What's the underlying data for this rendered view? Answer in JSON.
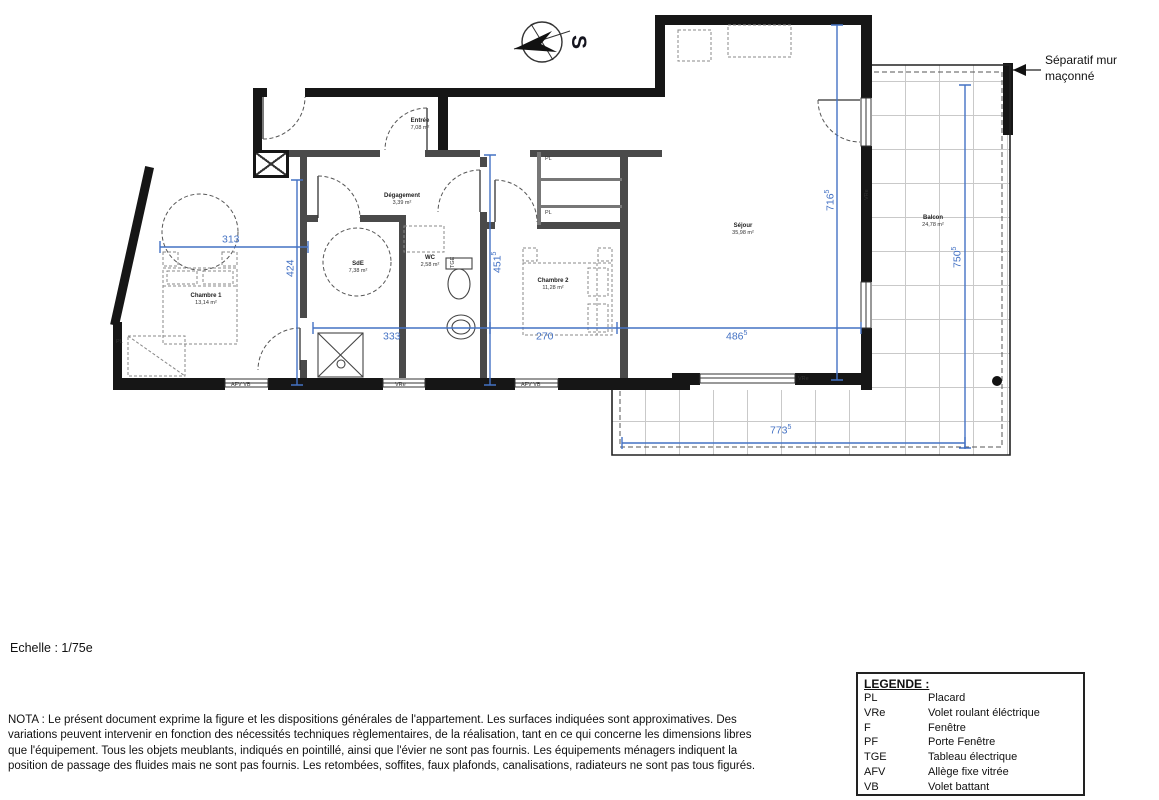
{
  "page": {
    "scale": "Echelle : 1/75e",
    "north_letter": "S",
    "separator_label": "Séparatif mur maçonné",
    "nota": "NOTA : Le présent document exprime la figure et les dispositions générales de l'appartement. Les surfaces indiquées sont approximatives. Des variations peuvent intervenir en fonction des nécessités techniques règlementaires, de la réalisation, tant en ce qui concerne les dimensions libres que l'équipement. Tous les objets meublants, indiqués en pointillé, ainsi que l'évier ne sont pas fournis. Les équipements ménagers indiquent la position de passage des fluides mais ne sont pas fournis. Les retombées, soffites, faux plafonds, canalisations, radiateurs ne sont pas tous figurés."
  },
  "rooms": {
    "entree": {
      "name": "Entrée",
      "area": "7,08 m²"
    },
    "degagement": {
      "name": "Dégagement",
      "area": "3,39 m²"
    },
    "chambre1": {
      "name": "Chambre 1",
      "area": "13,14 m²"
    },
    "sde": {
      "name": "SdE",
      "area": "7,38 m²"
    },
    "wc": {
      "name": "WC",
      "area": "2,58 m²"
    },
    "chambre2": {
      "name": "Chambre 2",
      "area": "11,28 m²"
    },
    "sejour": {
      "name": "Séjour",
      "area": "35,98 m²"
    },
    "balcon": {
      "name": "Balcon",
      "area": "24,78 m²"
    }
  },
  "dimensions": {
    "d313": {
      "text": "313"
    },
    "d424": {
      "text": "424"
    },
    "d333": {
      "text": "333"
    },
    "d270": {
      "text": "270"
    },
    "d451": {
      "text": "451",
      "sup": "5"
    },
    "d486": {
      "text": "486",
      "sup": "5"
    },
    "d716": {
      "text": "716",
      "sup": "5"
    },
    "d750": {
      "text": "750",
      "sup": "5"
    },
    "d773": {
      "text": "773",
      "sup": "5"
    }
  },
  "plan_labels": {
    "pl": "PL",
    "afv_vb": "AFV   VB",
    "vre": "VRe",
    "tge": "TGE"
  },
  "legend": {
    "title": "LEGENDE :",
    "items": [
      {
        "abbr": "PL",
        "desc": "Placard"
      },
      {
        "abbr": "VRe",
        "desc": "Volet roulant éléctrique"
      },
      {
        "abbr": "F",
        "desc": "Fenêtre"
      },
      {
        "abbr": "PF",
        "desc": "Porte Fenêtre"
      },
      {
        "abbr": "TGE",
        "desc": "Tableau électrique"
      },
      {
        "abbr": "AFV",
        "desc": "Allège fixe vitrée"
      },
      {
        "abbr": "VB",
        "desc": "Volet battant"
      }
    ]
  },
  "colors": {
    "dimension_blue": "#4472c4",
    "wall_black": "#161616"
  }
}
